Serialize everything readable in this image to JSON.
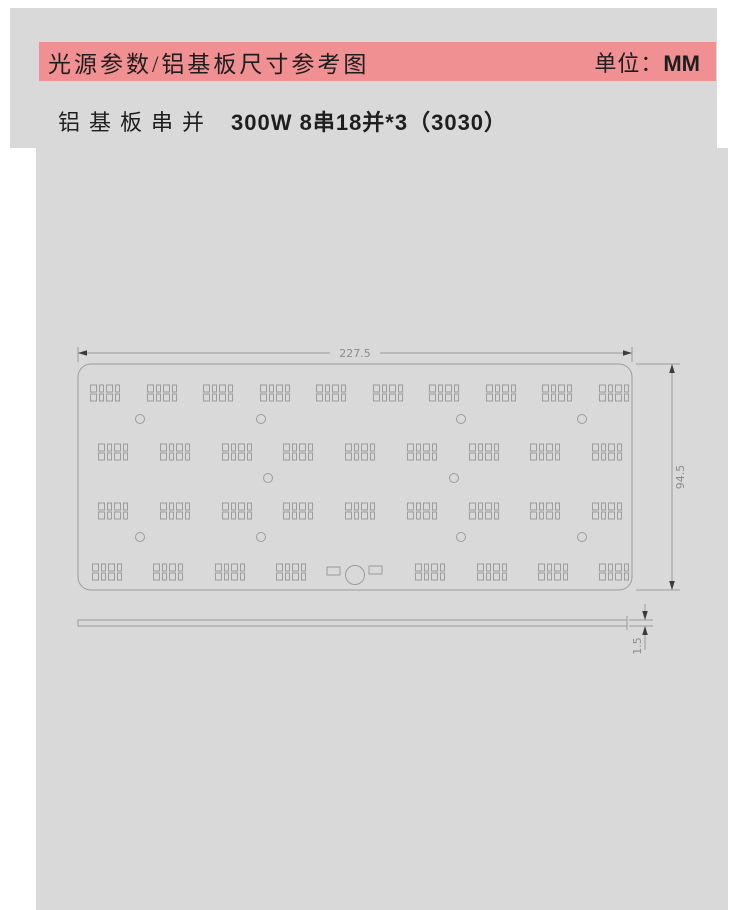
{
  "header": {
    "title": "光源参数/铝基板尺寸参考图",
    "unit_label": "单位：",
    "unit_value": "MM"
  },
  "subtitle": {
    "prefix": "铝基板串并",
    "spec": "300W 8串18并*3（3030）"
  },
  "colors": {
    "page_bg": "#ffffff",
    "panel_bg": "#d9d9d9",
    "header_bg": "#f09092",
    "line": "#9c9c9c",
    "dim_text": "#8c8c8c",
    "text": "#1e1e1e",
    "arrow": "#3c3c3c"
  },
  "drawing": {
    "dims": {
      "width": "227.5",
      "height": "94.5",
      "thickness": "1.5"
    },
    "board": {
      "x": 78,
      "y": 364,
      "w": 554,
      "h": 226,
      "r": 13
    },
    "led_cluster": {
      "pad_widths": [
        6,
        4,
        6,
        4
      ],
      "pad_h": 7,
      "gap_x": 3,
      "row_gap": 2
    },
    "led_rows": [
      {
        "y": 393,
        "xs": [
          105,
          162,
          218,
          275,
          331,
          388,
          444,
          501,
          557,
          614
        ]
      },
      {
        "y": 452,
        "xs": [
          113,
          175,
          237,
          298,
          360,
          422,
          484,
          545,
          607
        ]
      },
      {
        "y": 511,
        "xs": [
          113,
          175,
          237,
          298,
          360,
          422,
          484,
          545,
          607
        ]
      },
      {
        "y": 572,
        "xs": [
          107,
          168,
          230,
          291,
          430,
          492,
          553,
          614
        ]
      }
    ],
    "hole_rows": [
      {
        "y": 419,
        "xs": [
          140,
          261,
          461,
          582
        ]
      },
      {
        "y": 478,
        "xs": [
          268,
          454
        ]
      },
      {
        "y": 537,
        "xs": [
          140,
          261,
          461,
          582
        ]
      }
    ],
    "hole_r": 4.5,
    "connector": {
      "cx": 355,
      "cy": 575,
      "r": 9.5,
      "pads": [
        {
          "x": 327,
          "y": 567,
          "w": 13,
          "h": 8
        },
        {
          "x": 369,
          "y": 566,
          "w": 13,
          "h": 8
        }
      ]
    },
    "side_view": {
      "x": 78,
      "y": 620,
      "w": 549,
      "h": 6
    }
  }
}
